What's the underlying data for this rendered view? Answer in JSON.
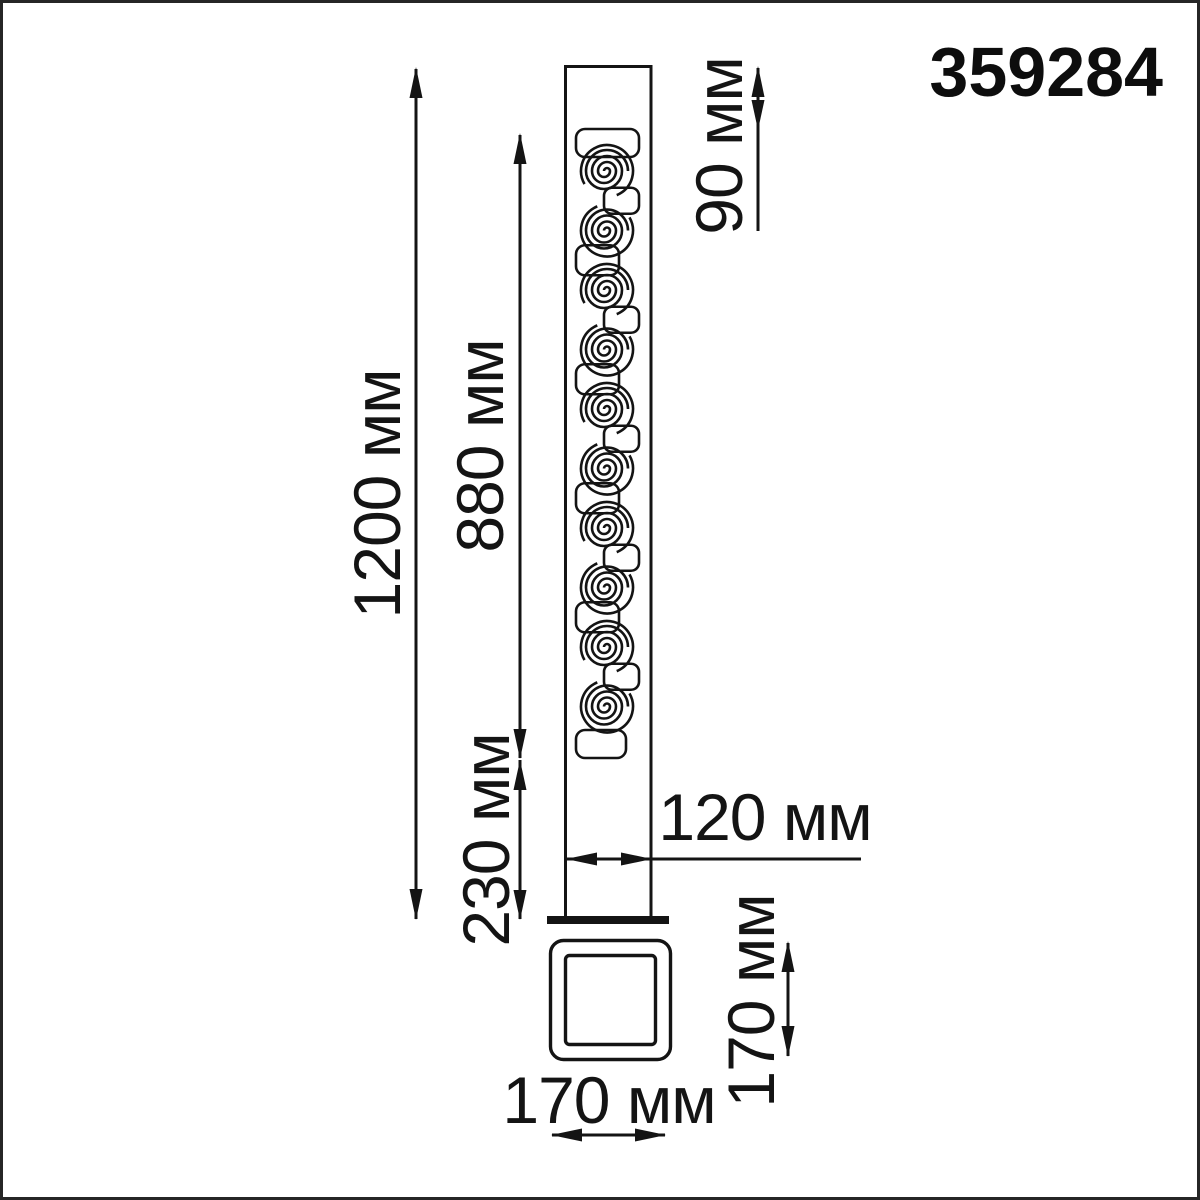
{
  "part_number": "359284",
  "colors": {
    "line": "#141414",
    "background": "#ffffff",
    "frame": "#262626"
  },
  "dimensions": {
    "total_height": {
      "value": 1200,
      "unit": "мм",
      "label": "1200 мм"
    },
    "ornament_height": {
      "value": 880,
      "unit": "мм",
      "label": "880 мм"
    },
    "top_section": {
      "value": 90,
      "unit": "мм",
      "label": "90 мм"
    },
    "bottom_section": {
      "value": 230,
      "unit": "мм",
      "label": "230 мм"
    },
    "pole_width": {
      "value": 120,
      "unit": "мм",
      "label": "120 мм"
    },
    "base_width": {
      "value": 170,
      "unit": "мм",
      "label": "170 мм"
    },
    "base_depth": {
      "value": 170,
      "unit": "мм",
      "label": "170 мм"
    }
  }
}
